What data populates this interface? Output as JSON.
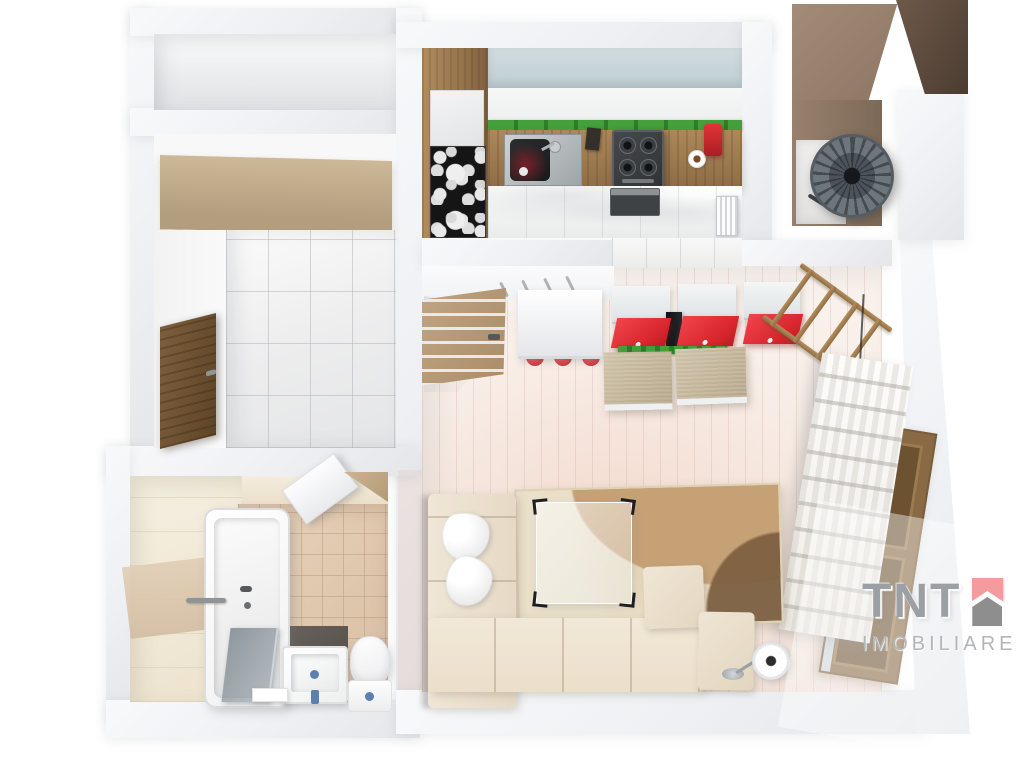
{
  "watermark": {
    "brand": "TNT",
    "subtitle": "IMOBILIARE",
    "icon": "house-icon",
    "colors": {
      "icon_pink": "#f59b9e",
      "icon_gray": "#8e8e8e",
      "brand_text": "#9aa0a3",
      "subtitle_text": "#b3b5b6"
    }
  },
  "scene": {
    "type": "3d-floor-plan-render",
    "subject": "top-down 3D render of a one-room apartment",
    "rooms": [
      "storage-niche",
      "hallway",
      "bathroom",
      "kitchen",
      "balcony",
      "living-room"
    ],
    "objects": {
      "hallway": [
        "wardrobe-top",
        "entrance-door",
        "white-tile-floor"
      ],
      "bathroom": [
        "bathtub",
        "shower-glass-screen",
        "washbasin",
        "toilet",
        "towel-rail",
        "open-door"
      ],
      "kitchen": [
        "frosted-window-strip",
        "tall-wood-cabinet",
        "art-print-fridge-panel",
        "wood-countertop",
        "sink",
        "knife-block",
        "gas-hob",
        "oven",
        "coffee-cup",
        "red-coffee-machine",
        "radiator",
        "glossy-tile-floor"
      ],
      "balcony": [
        "standing-fan",
        "brown-walls"
      ],
      "living-room": [
        "open-wood-door",
        "white-desk-with-red-stools",
        "tv-cabinet-red-fronts",
        "tv",
        "green-planter-strip",
        "ottoman",
        "ottoman",
        "ladder-shelf",
        "roman-blind",
        "wood-window",
        "area-rug",
        "glass-coffee-table",
        "corner-sofa",
        "pillows",
        "floor-lamp",
        "light-plank-floor"
      ]
    },
    "palette": {
      "background": "#ffffff",
      "walls": "#eef0f3",
      "kitchen_wood": "#a5825a",
      "entry_door_wood": "#6e5335",
      "living_floor": "#f6ece5",
      "bath_tile": "#dec7ae",
      "accent_red": "#e23a40",
      "accent_green": "#3e8e33",
      "balcony_brown": "#96806d"
    }
  }
}
